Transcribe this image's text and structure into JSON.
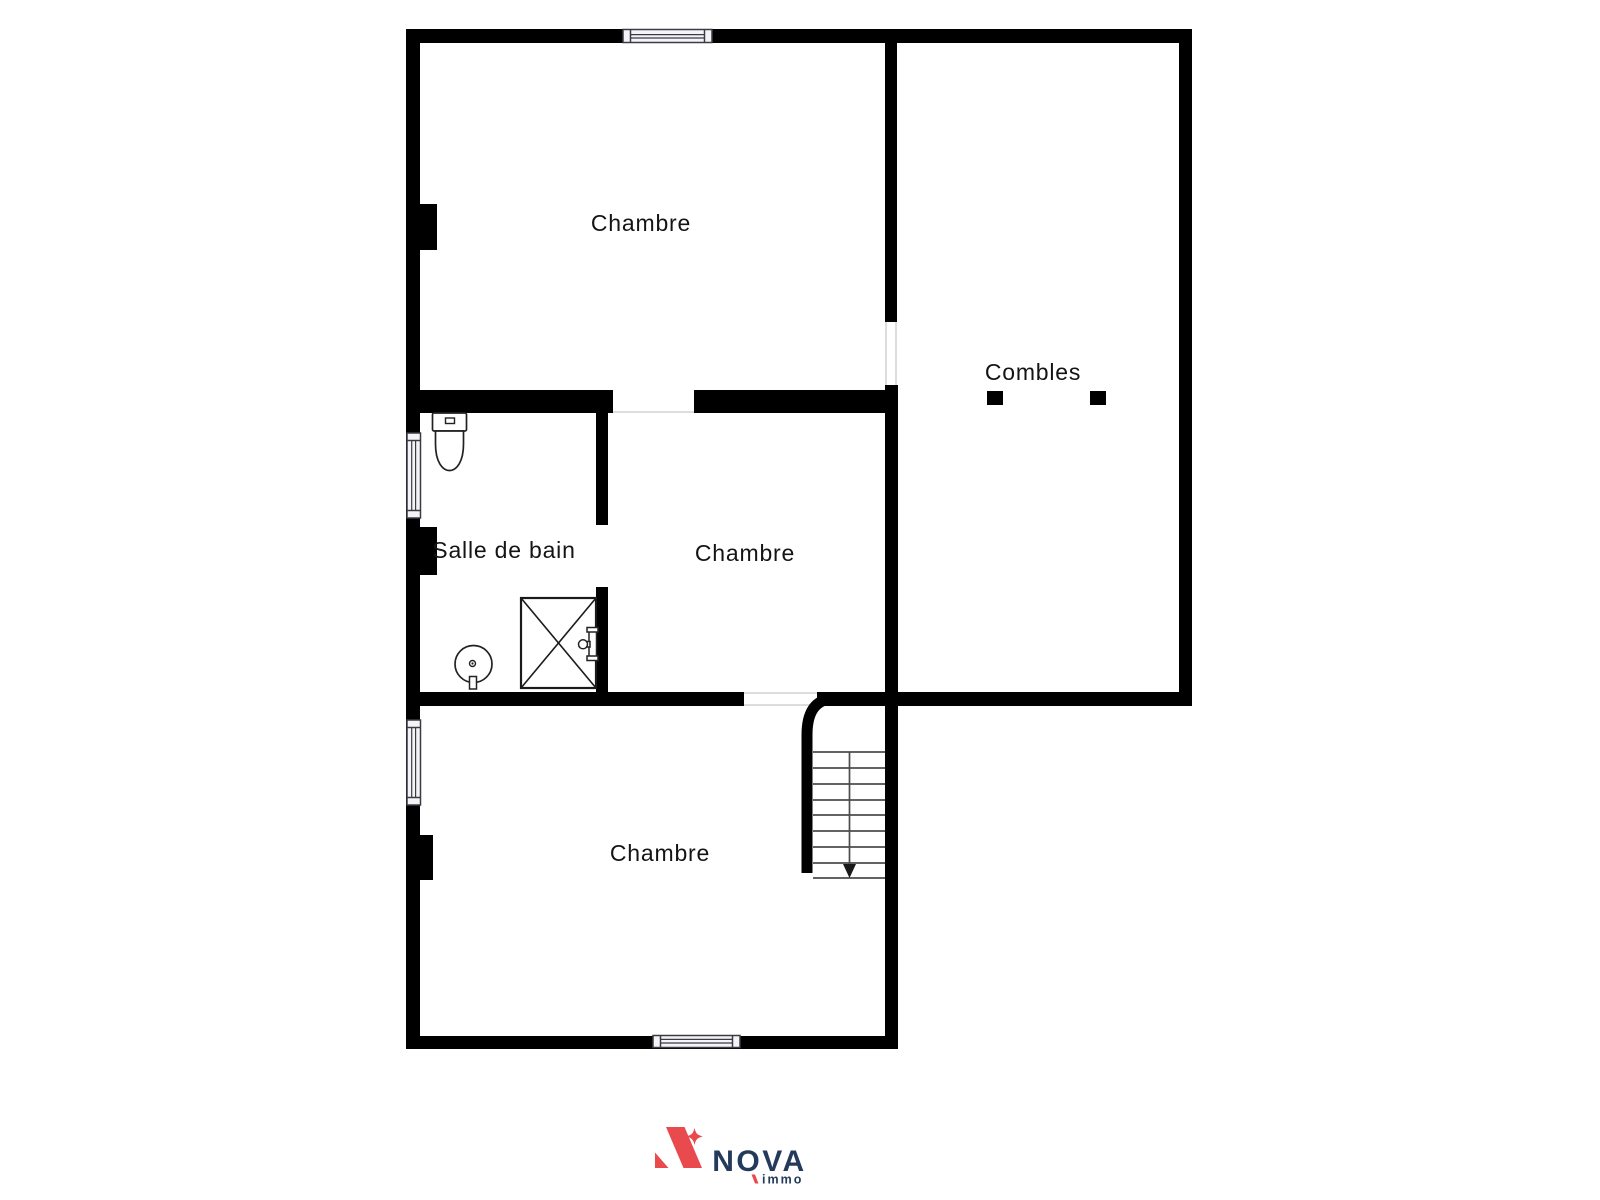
{
  "floor_plan": {
    "background": "#ffffff",
    "wall_color": "#000000",
    "label_color": "#141414",
    "window_fill": "#f4f4f8",
    "rooms": [
      {
        "id": "chambre-top",
        "label": "Chambre"
      },
      {
        "id": "combles",
        "label": "Combles"
      },
      {
        "id": "salle-de-bain",
        "label": "Salle de bain"
      },
      {
        "id": "chambre-middle",
        "label": "Chambre"
      },
      {
        "id": "chambre-bottom",
        "label": "Chambre"
      }
    ],
    "fixtures": [
      {
        "icon": "toilet-icon",
        "room": "salle-de-bain"
      },
      {
        "icon": "shower-icon",
        "room": "salle-de-bain"
      },
      {
        "icon": "sink-icon",
        "room": "salle-de-bain"
      },
      {
        "icon": "staircase-down-icon",
        "room": "chambre-bottom"
      }
    ],
    "window_count": 4,
    "stair_direction": "down"
  },
  "logo": {
    "brand": "NOVA",
    "tagline": "immo",
    "accent_color": "#e84a4e",
    "text_color": "#243a5a"
  }
}
